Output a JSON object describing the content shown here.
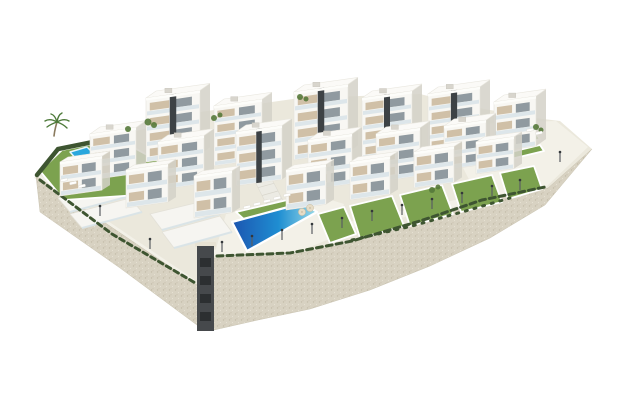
{
  "meta": {
    "label": "3D aerial rendering of a hillside residential complex: white modern apartment blocks with beige panels and glass balconies, terraced gardens, a large gradient-blue communal pool, a small left-garden plunge pool, a right terrace pool, hedges, palm tree and lamp posts above a curved beige stone retaining wall on a white background"
  },
  "colors": {
    "background": "#ffffff",
    "ground": "#ebe8dc",
    "groundLight": "#f3f1e8",
    "wall": "#d8d2c2",
    "wallLight": "#e7e2d3",
    "wallShadow": "#c3bca8",
    "facade": "#f8f7f3",
    "facadeShade": "#eceae3",
    "facadeDark": "#d4d1c8",
    "accentDark": "#3d4245",
    "glass": "#7e8a91",
    "panelBeige": "#ccbba1",
    "balconyGlass": "#d8e3e8",
    "lawn": "#7ca24f",
    "lawnDark": "#55793a",
    "hedge": "#3e5531",
    "poolDeep": "#1c55b0",
    "poolMid": "#1f8ed2",
    "poolLight": "#9cdbe8",
    "poolSmall": "#2aa7dd",
    "lamp": "#5a5e62",
    "shaft": "#46494c",
    "shaftDark": "#2c2f31",
    "white": "#ffffff",
    "trunk": "#8a7a5e",
    "frond": "#4e7a3a",
    "parasol": "#e6dcc6"
  },
  "scene": {
    "ground": [
      [
        36,
        176
      ],
      [
        58,
        148
      ],
      [
        120,
        136
      ],
      [
        200,
        112
      ],
      [
        300,
        98
      ],
      [
        420,
        94
      ],
      [
        468,
        106
      ],
      [
        535,
        118
      ],
      [
        560,
        121
      ],
      [
        592,
        149
      ],
      [
        548,
        188
      ],
      [
        480,
        203
      ],
      [
        420,
        224
      ],
      [
        350,
        243
      ],
      [
        290,
        256
      ],
      [
        214,
        258
      ],
      [
        200,
        287
      ],
      [
        110,
        233
      ]
    ],
    "wall_left": [
      [
        36,
        176
      ],
      [
        200,
        287
      ],
      [
        205,
        331
      ],
      [
        120,
        268
      ],
      [
        40,
        212
      ]
    ],
    "wall_right": [
      [
        214,
        258
      ],
      [
        290,
        255
      ],
      [
        350,
        243
      ],
      [
        420,
        223
      ],
      [
        480,
        202
      ],
      [
        548,
        188
      ],
      [
        592,
        149
      ],
      [
        545,
        205
      ],
      [
        490,
        238
      ],
      [
        430,
        266
      ],
      [
        370,
        290
      ],
      [
        310,
        309
      ],
      [
        258,
        320
      ],
      [
        214,
        330
      ]
    ],
    "path_left": [
      [
        37,
        173
      ],
      [
        195,
        280
      ],
      [
        191,
        285
      ],
      [
        34,
        178
      ]
    ],
    "path_right": [
      [
        213,
        250
      ],
      [
        542,
        182
      ],
      [
        546,
        188
      ],
      [
        215,
        256
      ]
    ],
    "deck_right": [
      [
        458,
        158
      ],
      [
        468,
        124
      ],
      [
        556,
        121
      ],
      [
        588,
        147
      ],
      [
        546,
        187
      ],
      [
        480,
        201
      ]
    ],
    "deck_main": [
      [
        214,
        256
      ],
      [
        226,
        214
      ],
      [
        312,
        194
      ],
      [
        344,
        204
      ],
      [
        332,
        238
      ],
      [
        290,
        255
      ]
    ],
    "shaft": {
      "x": 197,
      "y": 246,
      "w": 17,
      "h": 85,
      "slits": [
        258,
        276,
        294,
        312
      ]
    },
    "terraces": [
      [
        [
          58,
          198
        ],
        [
          118,
          184
        ],
        [
          130,
          196
        ],
        [
          70,
          212
        ]
      ],
      [
        [
          70,
          214
        ],
        [
          130,
          198
        ],
        [
          142,
          212
        ],
        [
          82,
          228
        ]
      ],
      [
        [
          150,
          214
        ],
        [
          208,
          200
        ],
        [
          220,
          214
        ],
        [
          162,
          230
        ]
      ],
      [
        [
          162,
          232
        ],
        [
          220,
          216
        ],
        [
          232,
          232
        ],
        [
          174,
          248
        ]
      ]
    ],
    "ramp": [
      [
        250,
        172
      ],
      [
        266,
        168
      ],
      [
        290,
        214
      ],
      [
        274,
        219
      ]
    ],
    "lawns": [
      [
        [
          40,
          171
        ],
        [
          62,
          150
        ],
        [
          118,
          139
        ],
        [
          160,
          162
        ],
        [
          152,
          194
        ],
        [
          64,
          200
        ]
      ],
      [
        [
          236,
          212
        ],
        [
          300,
          197
        ],
        [
          310,
          204
        ],
        [
          246,
          221
        ]
      ],
      [
        [
          318,
          214
        ],
        [
          344,
          207
        ],
        [
          356,
          234
        ],
        [
          330,
          243
        ]
      ],
      [
        [
          350,
          206
        ],
        [
          392,
          196
        ],
        [
          404,
          226
        ],
        [
          360,
          238
        ]
      ],
      [
        [
          400,
          195
        ],
        [
          442,
          185
        ],
        [
          453,
          214
        ],
        [
          410,
          226
        ]
      ],
      [
        [
          452,
          184
        ],
        [
          492,
          175
        ],
        [
          502,
          202
        ],
        [
          461,
          212
        ]
      ],
      [
        [
          500,
          173
        ],
        [
          534,
          166
        ],
        [
          542,
          189
        ],
        [
          508,
          199
        ]
      ],
      [
        [
          466,
          146
        ],
        [
          532,
          129
        ],
        [
          540,
          139
        ],
        [
          474,
          156
        ]
      ],
      [
        [
          474,
          161
        ],
        [
          540,
          145
        ],
        [
          544,
          151
        ],
        [
          478,
          167
        ]
      ]
    ],
    "pool_main": [
      [
        232,
        222
      ],
      [
        303,
        203
      ],
      [
        317,
        212
      ],
      [
        247,
        251
      ]
    ],
    "pool_small": [
      [
        70,
        152
      ],
      [
        87,
        147
      ],
      [
        95,
        155
      ],
      [
        78,
        161
      ]
    ],
    "pool_right": [
      [
        478,
        143
      ],
      [
        524,
        131
      ],
      [
        534,
        141
      ],
      [
        488,
        154
      ]
    ],
    "hedges": [
      {
        "pts": [
          [
            37,
            175
          ],
          [
            58,
            149
          ],
          [
            98,
            141
          ]
        ],
        "w": 4.5,
        "dash": ""
      },
      {
        "pts": [
          [
            40,
            180
          ],
          [
            112,
            234
          ],
          [
            197,
            284
          ]
        ],
        "w": 3,
        "dash": "5,4"
      },
      {
        "pts": [
          [
            217,
            256
          ],
          [
            290,
            253
          ],
          [
            352,
            241
          ],
          [
            420,
            221
          ],
          [
            482,
            200
          ],
          [
            545,
            187
          ]
        ],
        "w": 3,
        "dash": "6,4"
      },
      {
        "pts": [
          [
            352,
            240
          ],
          [
            412,
            226
          ],
          [
            462,
            212
          ],
          [
            510,
            198
          ]
        ],
        "w": 3,
        "dash": "2,7"
      }
    ],
    "buildings": [
      {
        "x": 146,
        "y": 98,
        "w": 54,
        "h": 64,
        "f": 4,
        "a": 1
      },
      {
        "x": 214,
        "y": 106,
        "w": 48,
        "h": 60,
        "f": 4,
        "a": 0
      },
      {
        "x": 294,
        "y": 92,
        "w": 54,
        "h": 68,
        "f": 4,
        "a": 1
      },
      {
        "x": 362,
        "y": 98,
        "w": 50,
        "h": 62,
        "f": 4,
        "a": 1
      },
      {
        "x": 428,
        "y": 94,
        "w": 52,
        "h": 60,
        "f": 4,
        "a": 1
      },
      {
        "x": 494,
        "y": 102,
        "w": 42,
        "h": 50,
        "f": 3,
        "a": 0
      },
      {
        "x": 90,
        "y": 134,
        "w": 46,
        "h": 46,
        "f": 3,
        "a": 0
      },
      {
        "x": 158,
        "y": 142,
        "w": 46,
        "h": 48,
        "f": 3,
        "a": 0
      },
      {
        "x": 236,
        "y": 132,
        "w": 46,
        "h": 54,
        "f": 3,
        "a": 1
      },
      {
        "x": 308,
        "y": 140,
        "w": 44,
        "h": 50,
        "f": 3,
        "a": 0
      },
      {
        "x": 376,
        "y": 134,
        "w": 44,
        "h": 48,
        "f": 3,
        "a": 0
      },
      {
        "x": 444,
        "y": 126,
        "w": 42,
        "h": 44,
        "f": 3,
        "a": 0
      },
      {
        "x": 60,
        "y": 162,
        "w": 42,
        "h": 34,
        "f": 2,
        "a": 0
      },
      {
        "x": 126,
        "y": 170,
        "w": 42,
        "h": 38,
        "f": 2,
        "a": 0
      },
      {
        "x": 194,
        "y": 176,
        "w": 38,
        "h": 42,
        "f": 2,
        "a": 0
      },
      {
        "x": 286,
        "y": 170,
        "w": 40,
        "h": 40,
        "f": 2,
        "a": 0
      },
      {
        "x": 350,
        "y": 162,
        "w": 40,
        "h": 38,
        "f": 2,
        "a": 0
      },
      {
        "x": 414,
        "y": 152,
        "w": 40,
        "h": 36,
        "f": 2,
        "a": 0
      },
      {
        "x": 476,
        "y": 142,
        "w": 38,
        "h": 32,
        "f": 2,
        "a": 0
      }
    ],
    "lamps": [
      [
        222,
        252
      ],
      [
        252,
        246
      ],
      [
        282,
        240
      ],
      [
        312,
        234
      ],
      [
        342,
        228
      ],
      [
        372,
        221
      ],
      [
        402,
        215
      ],
      [
        432,
        209
      ],
      [
        462,
        203
      ],
      [
        492,
        196
      ],
      [
        520,
        190
      ],
      [
        150,
        249
      ],
      [
        100,
        216
      ],
      [
        560,
        162
      ]
    ],
    "palms": [
      [
        54,
        136
      ]
    ],
    "bushes": [
      [
        148,
        122,
        3.5
      ],
      [
        154,
        125,
        3
      ],
      [
        128,
        129,
        3
      ],
      [
        300,
        97,
        3
      ],
      [
        306,
        99,
        2.5
      ],
      [
        432,
        190,
        3
      ],
      [
        438,
        187,
        2.5
      ],
      [
        536,
        127,
        3
      ],
      [
        541,
        130,
        2.5
      ],
      [
        214,
        118,
        3
      ],
      [
        220,
        115,
        2.5
      ]
    ],
    "loungers": [
      [
        64,
        180
      ],
      [
        73,
        183
      ],
      [
        82,
        186
      ],
      [
        247,
        207
      ],
      [
        257,
        204
      ],
      [
        267,
        201
      ],
      [
        277,
        198
      ],
      [
        287,
        195
      ],
      [
        530,
        130
      ],
      [
        539,
        133
      ]
    ],
    "parasols": [
      [
        302,
        212
      ],
      [
        310,
        208
      ]
    ]
  }
}
